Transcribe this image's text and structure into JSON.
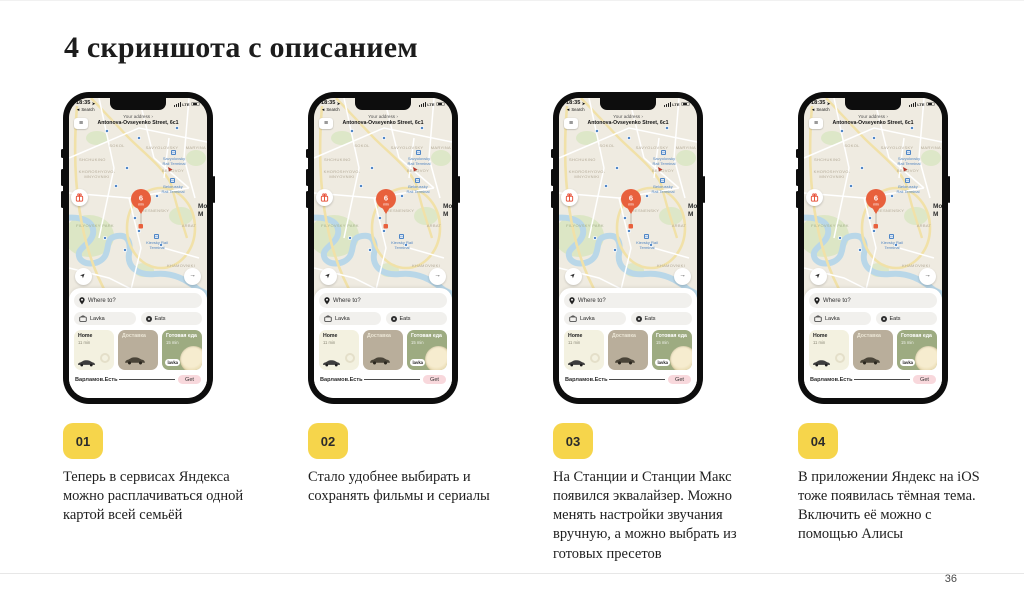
{
  "slide": {
    "title": "4 скриншота с описанием",
    "page_number": "36"
  },
  "items": [
    {
      "badge": "01",
      "description": "Теперь в сервисах Яндекса можно расплачиваться одной картой всей семьёй"
    },
    {
      "badge": "02",
      "description": "Стало удобнее выбирать и сохранять фильмы и сериалы"
    },
    {
      "badge": "03",
      "description": "На Станции и Станции Макс появился эквалайзер. Можно менять настройки звучания вручную, а можно выбрать из готовых пресетов"
    },
    {
      "badge": "04",
      "description": "В приложении Яндекс на iOS тоже появилась тёмная тема. Включить её можно с помощью Алисы"
    }
  ],
  "phone": {
    "status": {
      "time": "18:35",
      "back_label": "Search",
      "network": "LTE"
    },
    "address": {
      "label": "Your address",
      "street": "Antonova-Ovseyenko Street, 6с1"
    },
    "map": {
      "eta": {
        "value": "6",
        "unit": "min"
      },
      "labels": {
        "sokol": "SOKOL",
        "shchukino": "SHCHUKINO",
        "savyolovsky": "SAVYOLOVSKY",
        "maryina": "MARYINA",
        "begovoy": "BEGOVOY",
        "khoroshyovo1": "KHOROSHYOVO-",
        "khoroshyovo2": "MNYOVNIKI",
        "presnensky": "PRESNENSKY",
        "filyovsky": "FILYOVSKY PARK",
        "arbat": "ARBAT",
        "khamovniki": "KHAMOVNIKI",
        "city1": "Mo",
        "city2": "M"
      },
      "stations": {
        "sav1": "Savyolovsky",
        "sav2": "Rail Terminal",
        "bel1": "Belorussky",
        "bel2": "Rail Terminal",
        "kie1": "Kievsky Rail",
        "kie2": "Terminal"
      }
    },
    "sheet": {
      "where_to": "Where to?",
      "lavka": "Lavka",
      "eats": "Eats",
      "cards": [
        {
          "title": "Home",
          "subtitle": "11 min"
        },
        {
          "title": "Доставка"
        },
        {
          "title": "Готовая еда",
          "subtitle": "15 min",
          "badge": "lavka"
        }
      ],
      "banner": {
        "app": "Варламов.Есть",
        "action": "Get"
      }
    }
  },
  "icons": {
    "back": "◄",
    "nav_arrow": "➤",
    "chevron_right": "›",
    "menu": "≡",
    "forward_arrow": "→",
    "location_arrow": "➤"
  },
  "colors": {
    "accent_yellow": "#F6D54B",
    "pin_orange": "#E8603C",
    "get_pink": "#F8D8DC",
    "card_home": "#F3F1E0",
    "card_delivery": "#B9AE9B",
    "card_food": "#9DAB81",
    "map_background": "#EFEBE1",
    "station_blue": "#5286C2"
  }
}
